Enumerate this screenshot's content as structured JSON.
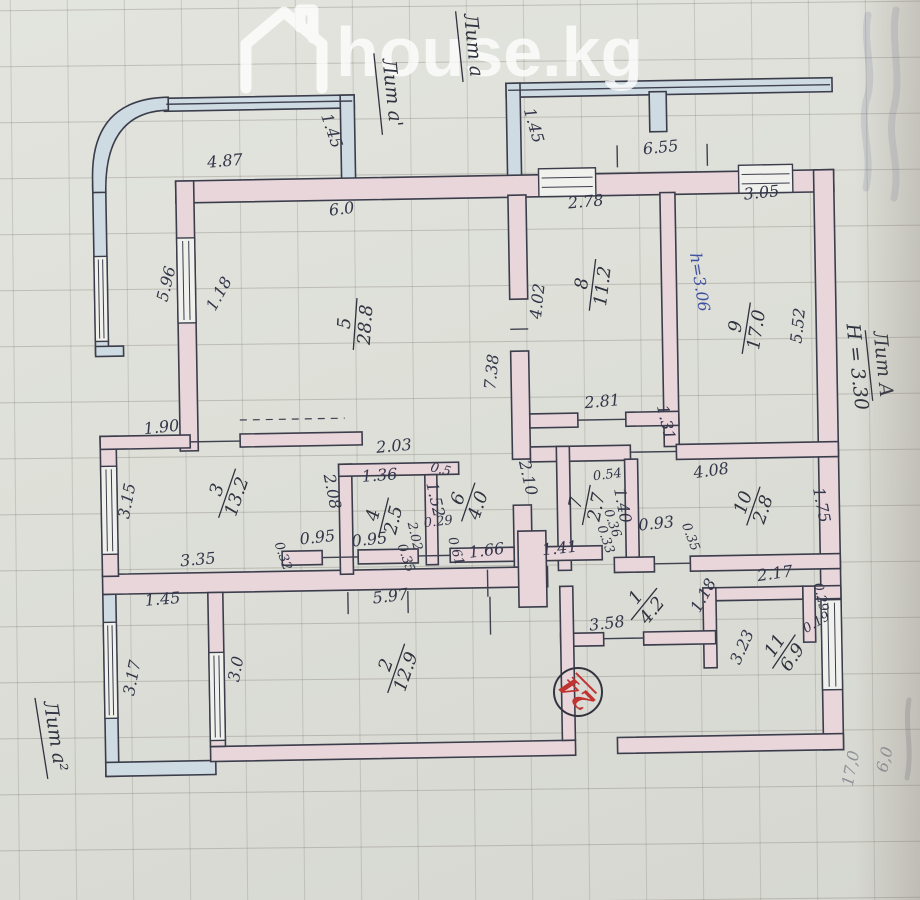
{
  "watermark": {
    "brand": "house.kg"
  },
  "stamp": {
    "value": "24"
  },
  "litera_labels": [
    {
      "lines": [
        "Лит а'"
      ],
      "x": 390,
      "y": 92,
      "rot": 85,
      "underline": true
    },
    {
      "lines": [
        "Лит а"
      ],
      "x": 472,
      "y": 46,
      "rot": 85,
      "underline": true
    },
    {
      "lines": [
        "Лит А",
        "Н = 3.30"
      ],
      "x": 876,
      "y": 372,
      "rot": 85,
      "underline": true
    },
    {
      "lines": [
        "Лит а²"
      ],
      "x": 42,
      "y": 730,
      "rot": 82,
      "underline": true
    }
  ],
  "rooms": [
    {
      "num": "1",
      "area": "4.2",
      "x": 641,
      "y": 607,
      "rot": -50
    },
    {
      "num": "2",
      "area": "12.9",
      "x": 392,
      "y": 667,
      "rot": -70
    },
    {
      "num": "3",
      "area": "13.2",
      "x": 226,
      "y": 489,
      "rot": -70
    },
    {
      "num": "4",
      "area": "2.5",
      "x": 382,
      "y": 516,
      "rot": -75
    },
    {
      "num": "5",
      "area": "28.8",
      "x": 357,
      "y": 322,
      "rot": -85
    },
    {
      "num": "6",
      "area": "4.0",
      "x": 467,
      "y": 502,
      "rot": -70
    },
    {
      "num": "7",
      "area": "2.7",
      "x": 585,
      "y": 507,
      "rot": -78
    },
    {
      "num": "8",
      "area": "11.2",
      "x": 595,
      "y": 287,
      "rot": -82
    },
    {
      "num": "9",
      "area": "17.0",
      "x": 748,
      "y": 333,
      "rot": -80
    },
    {
      "num": "10",
      "area": "2.8",
      "x": 752,
      "y": 511,
      "rot": -70
    },
    {
      "num": "11",
      "area": "6.9",
      "x": 780,
      "y": 657,
      "rot": -55
    }
  ],
  "dimensions": [
    {
      "t": "1.45",
      "x": 332,
      "y": 130,
      "r": 72
    },
    {
      "t": "4.87",
      "x": 230,
      "y": 162,
      "r": -4
    },
    {
      "t": "6.0",
      "x": 346,
      "y": 212,
      "r": -6
    },
    {
      "t": "1.45",
      "x": 534,
      "y": 128,
      "r": 75
    },
    {
      "t": "6.55",
      "x": 666,
      "y": 156,
      "r": -5
    },
    {
      "t": "2.78",
      "x": 590,
      "y": 209,
      "r": -4
    },
    {
      "t": "3.05",
      "x": 766,
      "y": 203,
      "r": -5
    },
    {
      "t": "5.96",
      "x": 174,
      "y": 280,
      "r": -75
    },
    {
      "t": "1.18",
      "x": 226,
      "y": 292,
      "r": -60
    },
    {
      "t": "4.02",
      "x": 545,
      "y": 303,
      "r": -83
    },
    {
      "t": "7.38",
      "x": 498,
      "y": 373,
      "r": -83
    },
    {
      "t": "5.52",
      "x": 805,
      "y": 332,
      "r": -83
    },
    {
      "t": "h=3.06",
      "x": 697,
      "y": 287,
      "r": 82,
      "c": "blue"
    },
    {
      "t": "2.81",
      "x": 603,
      "y": 409,
      "r": -4
    },
    {
      "t": "1.31",
      "x": 661,
      "y": 427,
      "r": 78
    },
    {
      "t": "1.90",
      "x": 162,
      "y": 427,
      "r": -5
    },
    {
      "t": "2.03",
      "x": 394,
      "y": 450,
      "r": -4
    },
    {
      "t": "3.15",
      "x": 131,
      "y": 496,
      "r": -78
    },
    {
      "t": "1.36",
      "x": 379,
      "y": 479,
      "r": -3
    },
    {
      "t": "2.08",
      "x": 326,
      "y": 490,
      "r": 80
    },
    {
      "t": "0.5",
      "x": 439,
      "y": 473,
      "r": 15,
      "s": "small"
    },
    {
      "t": "1.52",
      "x": 429,
      "y": 500,
      "r": 78
    },
    {
      "t": "2.10",
      "x": 522,
      "y": 480,
      "r": 78
    },
    {
      "t": "0.54",
      "x": 607,
      "y": 481,
      "r": -6,
      "s": "small"
    },
    {
      "t": "1.40",
      "x": 616,
      "y": 509,
      "r": 80
    },
    {
      "t": "4.08",
      "x": 711,
      "y": 480,
      "r": -7
    },
    {
      "t": "1.75",
      "x": 815,
      "y": 512,
      "r": 80
    },
    {
      "t": "0.36",
      "x": 607,
      "y": 527,
      "r": 72,
      "s": "small"
    },
    {
      "t": "0.33",
      "x": 600,
      "y": 543,
      "r": 72,
      "s": "small"
    },
    {
      "t": "0.93",
      "x": 655,
      "y": 532,
      "r": -5
    },
    {
      "t": "0.35",
      "x": 685,
      "y": 542,
      "r": 70,
      "s": "small"
    },
    {
      "t": "0.95",
      "x": 316,
      "y": 540,
      "r": -5
    },
    {
      "t": "0.32",
      "x": 277,
      "y": 554,
      "r": 72,
      "s": "small"
    },
    {
      "t": "3.35",
      "x": 196,
      "y": 560,
      "r": -4
    },
    {
      "t": "0.95",
      "x": 368,
      "y": 543,
      "r": -5
    },
    {
      "t": "2.02",
      "x": 409,
      "y": 536,
      "r": 78,
      "s": "small"
    },
    {
      "t": "0.35",
      "x": 400,
      "y": 558,
      "r": 72,
      "s": "small"
    },
    {
      "t": "0.29",
      "x": 437,
      "y": 525,
      "r": -5,
      "s": "small"
    },
    {
      "t": "0.61",
      "x": 450,
      "y": 552,
      "r": 75,
      "s": "small"
    },
    {
      "t": "1.66",
      "x": 485,
      "y": 556,
      "r": -6
    },
    {
      "t": "1.41",
      "x": 558,
      "y": 555,
      "r": -5
    },
    {
      "t": "5.97",
      "x": 388,
      "y": 600,
      "r": -6
    },
    {
      "t": "2.17",
      "x": 773,
      "y": 584,
      "r": -7
    },
    {
      "t": "0.29",
      "x": 814,
      "y": 604,
      "r": 78,
      "s": "small"
    },
    {
      "t": "0.19",
      "x": 815,
      "y": 632,
      "r": -30,
      "s": "small"
    },
    {
      "t": "1.18",
      "x": 705,
      "y": 602,
      "r": -60
    },
    {
      "t": "3.23",
      "x": 743,
      "y": 654,
      "r": -65
    },
    {
      "t": "3.58",
      "x": 604,
      "y": 631,
      "r": -6
    },
    {
      "t": "1.45",
      "x": 160,
      "y": 599,
      "r": -4
    },
    {
      "t": "3.17",
      "x": 133,
      "y": 673,
      "r": -78
    },
    {
      "t": "3.0",
      "x": 237,
      "y": 666,
      "r": -78
    },
    {
      "t": "17,0",
      "x": 850,
      "y": 776,
      "r": -78,
      "c": "pencil"
    },
    {
      "t": "6,0",
      "x": 884,
      "y": 768,
      "r": -75,
      "c": "pencil"
    }
  ]
}
